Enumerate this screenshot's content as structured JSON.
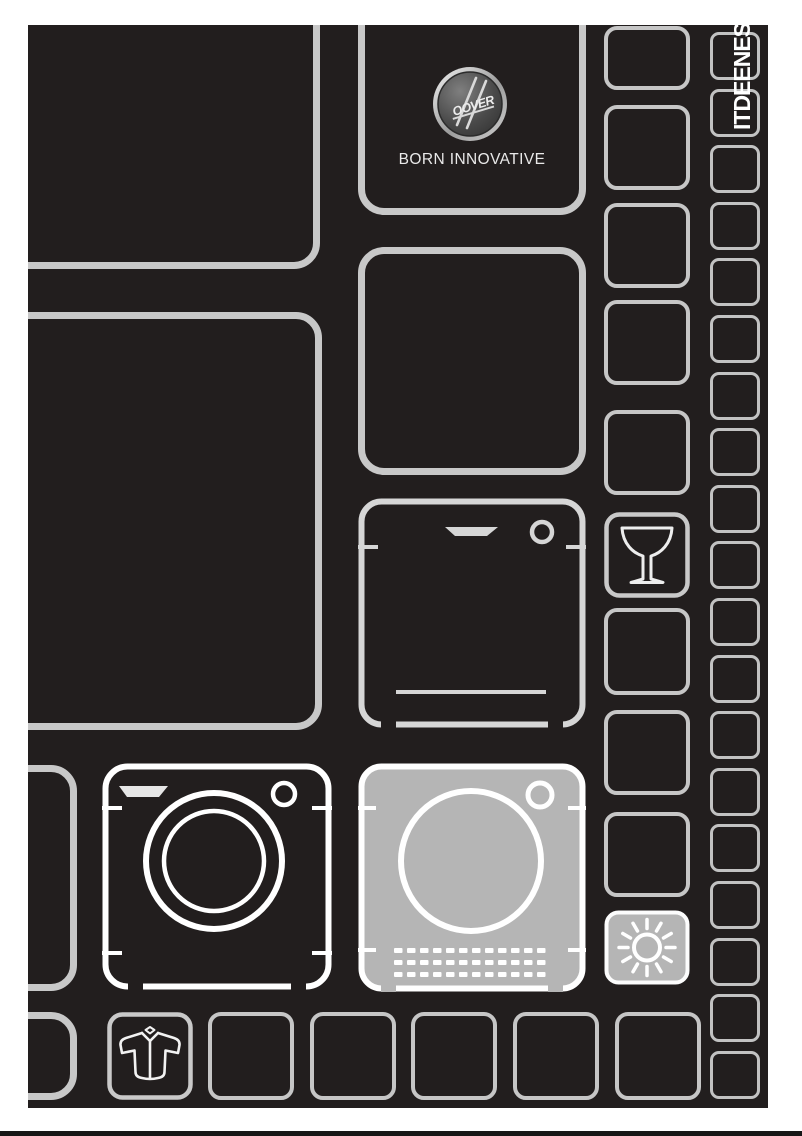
{
  "brand": {
    "badge_text": "OOVER",
    "tagline": "BORN INNOVATIVE"
  },
  "languages": {
    "label": "ITDEENES",
    "codes": [
      "IT",
      "DE",
      "EN",
      "ES"
    ]
  },
  "icons": {
    "badge": "hoover-badge-icon",
    "dishwasher": "dishwasher-icon",
    "washing_machine": "washing-machine-icon",
    "tumble_dryer": "tumble-dryer-icon",
    "wine_glass": "wine-glass-icon",
    "sun": "sun-icon",
    "shirt": "shirt-icon"
  },
  "colors": {
    "page_background": "#ffffff",
    "canvas_black": "#221e1e",
    "grid_stroke": "#c8c8c8",
    "bright_stroke": "#ffffff",
    "highlight_fill": "#b5b5b5",
    "footer_bar": "#161616"
  }
}
